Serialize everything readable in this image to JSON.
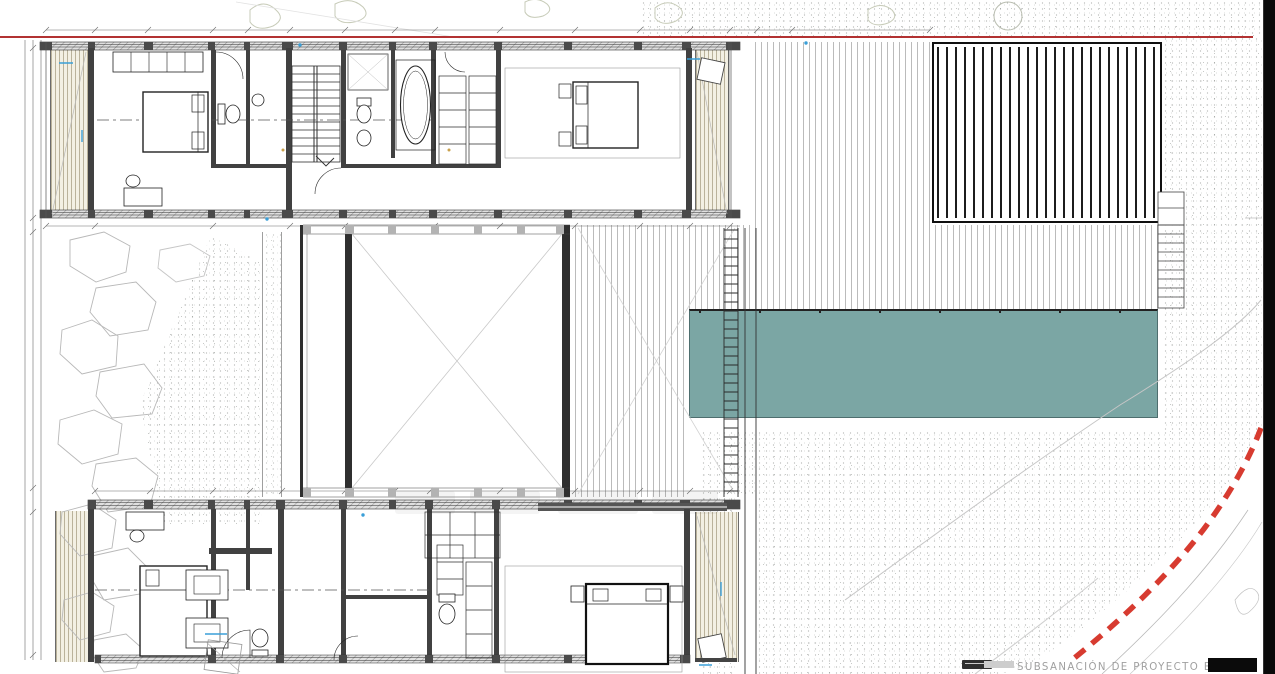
{
  "title_block": {
    "revision_label": "SUBSANACIÓN DE PROYECTO BÁSICO"
  },
  "colors": {
    "pool_water": "#7BA6A4",
    "plot_boundary": "#D42A1E",
    "alignment_line": "#B23232",
    "terrace_floor": "#F3F0E3",
    "pergola_stripe": "#1C1C1C",
    "wall": "#414141",
    "edge_bar": "#0A0A0A",
    "water_accent": "#3A9FD8"
  },
  "legend": {
    "areas": [
      "upper-wing",
      "lower-wing",
      "central-courtyard",
      "swimming-pool",
      "timber-deck",
      "pergola-deck",
      "terraces",
      "rock-garden",
      "gravel-terrain",
      "plot-boundary"
    ]
  }
}
